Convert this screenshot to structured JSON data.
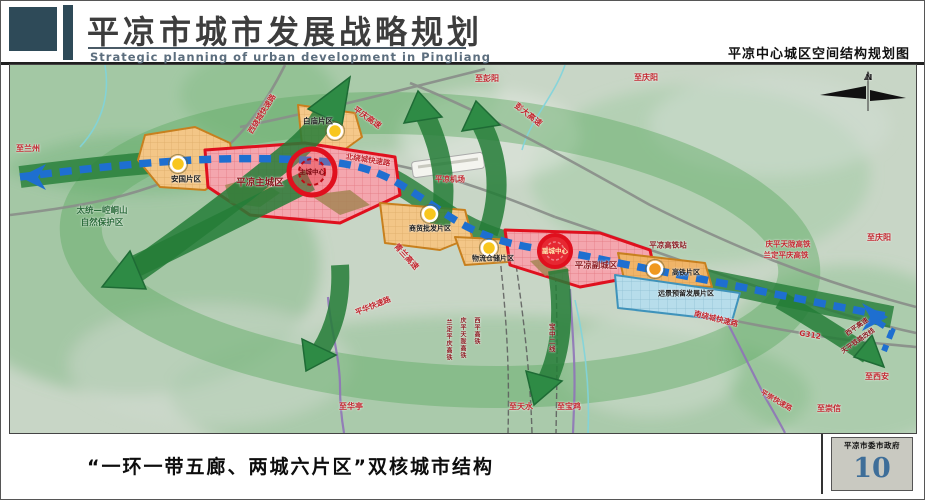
{
  "header": {
    "title_cn": "平凉市城市发展战略规划",
    "title_en": "Strategic planning of urban development in Pingliang",
    "right_caption": "平凉中心城区空间结构规划图"
  },
  "footer": {
    "caption": "“一环一带五廊、两城六片区”双核城市结构",
    "org": "平凉市委市政府",
    "page_number": "10"
  },
  "palette": {
    "header_navy": "#2e4a58",
    "corridor_green": "#2e8b45",
    "belt_blue": "#1e6fd0",
    "zone_red_border": "#e0101e",
    "zone_red_fill": "#f4a6ae",
    "zone_orange_border": "#c8801e",
    "zone_orange_fill": "#f3c687",
    "zone_future_blue_fill": "#b7ddeb",
    "label_red": "#c0252d",
    "page_number_blue": "#3e6e99",
    "node_yellow": "#f8c61e"
  },
  "map": {
    "labels": [
      {
        "name": "to-lanzhou",
        "text": "至兰州",
        "x": 18,
        "y": 84,
        "size": 8,
        "cls": "red"
      },
      {
        "name": "nature-reserve-line1",
        "text": "太统—崆峒山",
        "x": 92,
        "y": 146,
        "size": 8.5,
        "cls": "green"
      },
      {
        "name": "nature-reserve-line2",
        "text": "自然保护区",
        "x": 92,
        "y": 158,
        "size": 8.5,
        "cls": "green"
      },
      {
        "name": "zone-anguo-label",
        "text": "安国片区",
        "x": 176,
        "y": 114,
        "size": 7.5,
        "cls": "black"
      },
      {
        "name": "zone-main-city-label",
        "text": "平凉主城区",
        "x": 250,
        "y": 118,
        "size": 9.5,
        "cls": "darkred"
      },
      {
        "name": "main-center-label",
        "text": "主城中心",
        "x": 302,
        "y": 107,
        "size": 6.5,
        "cls": "maroon"
      },
      {
        "name": "zone-baimiao-label",
        "text": "白庙片区",
        "x": 308,
        "y": 56,
        "size": 7.5,
        "cls": "black"
      },
      {
        "name": "xi-ring-expressway",
        "text": "西绕城快速路",
        "x": 252,
        "y": 49,
        "size": 7.5,
        "cls": "red",
        "rot": -58
      },
      {
        "name": "pingqing-expressway",
        "text": "平庆高速",
        "x": 357,
        "y": 53,
        "size": 8,
        "cls": "red",
        "rot": 35
      },
      {
        "name": "bei-ring-expressway",
        "text": "北绕城快速路",
        "x": 358,
        "y": 95,
        "size": 7.5,
        "cls": "red",
        "rot": 9
      },
      {
        "name": "to-pengyang",
        "text": "至彭阳",
        "x": 477,
        "y": 14,
        "size": 8,
        "cls": "red"
      },
      {
        "name": "pengda-expressway",
        "text": "彭大高速",
        "x": 518,
        "y": 50,
        "size": 8,
        "cls": "red",
        "rot": 38
      },
      {
        "name": "to-qingyang-top",
        "text": "至庆阳",
        "x": 636,
        "y": 13,
        "size": 8,
        "cls": "red"
      },
      {
        "name": "airport-label",
        "text": "平凉机场",
        "x": 440,
        "y": 114,
        "size": 7.5,
        "cls": "red"
      },
      {
        "name": "qinglan-expressway",
        "text": "青兰高速",
        "x": 396,
        "y": 192,
        "size": 8,
        "cls": "red",
        "rot": 48
      },
      {
        "name": "zone-trade-label",
        "text": "商贸批发片区",
        "x": 420,
        "y": 164,
        "size": 7,
        "cls": "black"
      },
      {
        "name": "zone-logistics-label",
        "text": "物流仓储片区",
        "x": 483,
        "y": 194,
        "size": 7,
        "cls": "black"
      },
      {
        "name": "sub-center-label",
        "text": "副城中心",
        "x": 545,
        "y": 186,
        "size": 6.5,
        "cls": "cream"
      },
      {
        "name": "zone-sub-city-label",
        "text": "平凉副城区",
        "x": 586,
        "y": 201,
        "size": 8.5,
        "cls": "darkred"
      },
      {
        "name": "hsr-station-label",
        "text": "平凉高铁站",
        "x": 658,
        "y": 180,
        "size": 7.5,
        "cls": "darkred"
      },
      {
        "name": "zone-hsr-label",
        "text": "高铁片区",
        "x": 676,
        "y": 208,
        "size": 7,
        "cls": "black"
      },
      {
        "name": "zone-future-label",
        "text": "远景预留发展片区",
        "x": 676,
        "y": 229,
        "size": 7,
        "cls": "black"
      },
      {
        "name": "nan-ring-expressway",
        "text": "南绕城快速路",
        "x": 706,
        "y": 254,
        "size": 7.5,
        "cls": "red",
        "rot": 14
      },
      {
        "name": "g312-label",
        "text": "G312",
        "x": 800,
        "y": 270,
        "size": 7.5,
        "cls": "red",
        "rot": 10
      },
      {
        "name": "qingpingtianlong-hsr",
        "text": "庆平天陇高铁",
        "x": 778,
        "y": 179,
        "size": 7.5,
        "cls": "red"
      },
      {
        "name": "landingpingqing-hsr",
        "text": "兰定平庆高铁",
        "x": 776,
        "y": 190,
        "size": 7.5,
        "cls": "red"
      },
      {
        "name": "to-qingyang-right",
        "text": "至庆阳",
        "x": 869,
        "y": 173,
        "size": 8,
        "cls": "red"
      },
      {
        "name": "xiping-expressway",
        "text": "西平高速",
        "x": 847,
        "y": 262,
        "size": 6.5,
        "cls": "darkred",
        "rot": -35
      },
      {
        "name": "tianping-railway",
        "text": "天平铁路改线",
        "x": 848,
        "y": 276,
        "size": 6.5,
        "cls": "darkred",
        "rot": -35
      },
      {
        "name": "to-xian",
        "text": "至西安",
        "x": 867,
        "y": 312,
        "size": 8,
        "cls": "red"
      },
      {
        "name": "to-chongxin",
        "text": "至崇信",
        "x": 819,
        "y": 344,
        "size": 8,
        "cls": "red"
      },
      {
        "name": "pingchong-expressway",
        "text": "平崇快速路",
        "x": 766,
        "y": 336,
        "size": 7,
        "cls": "red",
        "rot": 30
      },
      {
        "name": "pinghua-expressway",
        "text": "平华快速路",
        "x": 363,
        "y": 241,
        "size": 7.5,
        "cls": "red",
        "rot": -22
      },
      {
        "name": "to-huating",
        "text": "至华亭",
        "x": 341,
        "y": 342,
        "size": 8,
        "cls": "red"
      },
      {
        "name": "rail-landingpingqing-v",
        "text": "兰定平庆高铁",
        "x": 438,
        "y": 254,
        "size": 6,
        "cls": "darkred",
        "vertical": true
      },
      {
        "name": "rail-qingpingtianlong-v",
        "text": "庆平天陇高铁",
        "x": 452,
        "y": 252,
        "size": 6,
        "cls": "darkred",
        "vertical": true
      },
      {
        "name": "rail-xiping-v",
        "text": "西平高铁",
        "x": 466,
        "y": 252,
        "size": 6,
        "cls": "darkred",
        "vertical": true
      },
      {
        "name": "rail-baozhong-v",
        "text": "宝中二线",
        "x": 541,
        "y": 258,
        "size": 6.5,
        "cls": "darkred",
        "vertical": true
      },
      {
        "name": "to-tianshui",
        "text": "至天水",
        "x": 511,
        "y": 342,
        "size": 8,
        "cls": "red"
      },
      {
        "name": "to-baoji",
        "text": "至宝鸡",
        "x": 559,
        "y": 342,
        "size": 8,
        "cls": "red"
      },
      {
        "name": "compass-n",
        "text": "N",
        "x": 859,
        "y": 13,
        "size": 8,
        "cls": "black"
      }
    ]
  }
}
